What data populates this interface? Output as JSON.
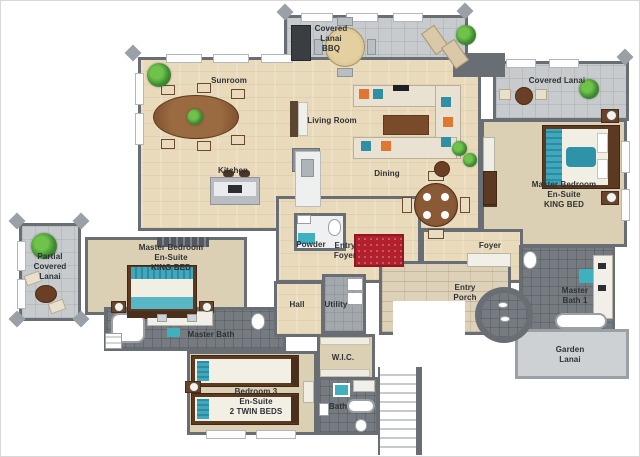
{
  "title": "3D Floor Plan",
  "palette": {
    "wall": "#696e75",
    "wood_floor": "#e8dabb",
    "carpet_floor": "#dcd0b4",
    "bath_tile": "#767b81",
    "lanai_floor": "#c8cbcd",
    "porch_floor": "#ddd2b9",
    "teal_accent": "#3fb0bd",
    "orange_accent": "#e0762f",
    "rug_red": "#b2202c",
    "furniture_brown": "#7a4b2a",
    "plant_green": "#4a9b3e"
  },
  "rooms": [
    {
      "id": "covered-lanai-bbq",
      "label": "Covered\nLanai\nBBQ"
    },
    {
      "id": "sunroom",
      "label": "Sunroom"
    },
    {
      "id": "covered-lanai",
      "label": "Covered Lanai"
    },
    {
      "id": "living-room",
      "label": "Living Room"
    },
    {
      "id": "kitchen",
      "label": "Kitchen"
    },
    {
      "id": "dining",
      "label": "Dining"
    },
    {
      "id": "master-bedroom-2",
      "label": "Master Bedroom\nEn-Suite\nKING BED"
    },
    {
      "id": "powder",
      "label": "Powder"
    },
    {
      "id": "entry-foyer",
      "label": "Entry\nFoyer"
    },
    {
      "id": "foyer",
      "label": "Foyer"
    },
    {
      "id": "partial-covered-lanai",
      "label": "Partial\nCovered\nLanai"
    },
    {
      "id": "master-bedroom-1",
      "label": "Master Bedroom\nEn-Suite\nKING BED"
    },
    {
      "id": "hall",
      "label": "Hall"
    },
    {
      "id": "utility",
      "label": "Utility"
    },
    {
      "id": "master-bath",
      "label": "Master Bath"
    },
    {
      "id": "entry-porch",
      "label": "Entry\nPorch"
    },
    {
      "id": "master-bath-1",
      "label": "Master\nBath 1"
    },
    {
      "id": "garden-lanai",
      "label": "Garden\nLanai"
    },
    {
      "id": "wic",
      "label": "W.I.C."
    },
    {
      "id": "bedroom-3",
      "label": "Bedroom 3\nEn-Suite\n2 TWIN BEDS"
    },
    {
      "id": "bath",
      "label": "Bath"
    }
  ]
}
